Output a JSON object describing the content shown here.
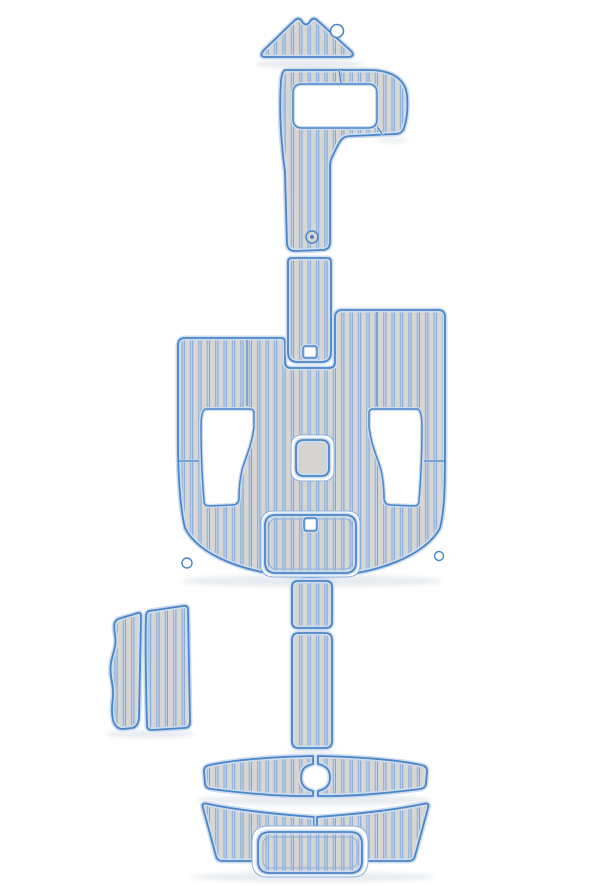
{
  "image": {
    "subject": "EVA foam teak-style boat decking pad kit, full set laid out in boat-deck arrangement on white background",
    "background_color": "#ffffff"
  },
  "canvas": {
    "width": 600,
    "height": 886
  },
  "colors": {
    "plank": "#d8d6d2",
    "groove": "#7aa4d8",
    "groove_light": "#c5d5eb",
    "edge": "#4a85c8",
    "halo": "#cddcef",
    "plain_pad": "#d6d4d0",
    "recess_stroke": "#8fb2de",
    "white": "#ffffff",
    "shadow": "#dfe4ea"
  },
  "pattern": {
    "plank_pitch": 8.4,
    "plank_width": 5.2,
    "groove_line": 1.0,
    "groove_gap": 1.2
  },
  "shadows": [
    {
      "cx": 309,
      "cy": 64,
      "rx": 54,
      "ry": 4.5,
      "o": 0.75
    },
    {
      "cx": 392,
      "cy": 140,
      "rx": 16,
      "ry": 3,
      "o": 0.6
    },
    {
      "cx": 312,
      "cy": 581,
      "rx": 132,
      "ry": 6,
      "o": 0.7
    },
    {
      "cx": 150,
      "cy": 734,
      "rx": 45,
      "ry": 4,
      "o": 0.7
    },
    {
      "cx": 312,
      "cy": 752,
      "rx": 26,
      "ry": 3,
      "o": 0.6
    },
    {
      "cx": 315,
      "cy": 800,
      "rx": 118,
      "ry": 5.5,
      "o": 0.7
    },
    {
      "cx": 313,
      "cy": 877,
      "rx": 122,
      "ry": 5,
      "o": 0.7
    }
  ],
  "pieces": [
    {
      "id": "cockpit-floor-pad",
      "label": "main cockpit floor pad with seat cutouts",
      "fill": "planks",
      "path": "M 188,338 L 281,338 Q 285,338 285,342 L 285,362 Q 285,368 291,368 L 329,368 Q 335,368 335,362 L 335,316 Q 336,310 342,310 L 438,310 Q 445,310 445,317 L 445,452 C 445,492 444,512 440,528 C 427,553 381,576 312,577 C 243,576 197,553 185,528 C 180,508 178,472 178,442 L 178,345 Q 178,338 185,338 Z",
      "features": [
        {
          "type": "groove",
          "x1": 247,
          "y1": 340,
          "x2": 247,
          "y2": 406
        },
        {
          "type": "groove",
          "x1": 377,
          "y1": 312,
          "x2": 377,
          "y2": 406
        },
        {
          "type": "groove",
          "x1": 179,
          "y1": 461,
          "x2": 199,
          "y2": 461
        },
        {
          "type": "groove",
          "x1": 424,
          "y1": 461,
          "x2": 444,
          "y2": 461
        },
        {
          "type": "cutout-path",
          "path": "M 206,409 L 250,409 Q 254,409 254,413 L 254,427 C 252,445 246,456 242,470 C 240,479 239,489 239,498 Q 239,505 232,505 L 209,506 Q 204,506 204,501 C 202,478 201,452 201,427 Q 201,409 206,409 Z"
        },
        {
          "type": "cutout-path",
          "path": "M 417,409 L 373,409 Q 369,409 369,413 L 369,427 C 371,445 377,456 381,470 C 383,479 384,489 384,498 Q 384,505 391,505 L 414,506 Q 419,506 419,501 C 421,478 422,452 422,427 Q 422,409 417,409 Z"
        },
        {
          "type": "notch",
          "cx": 187,
          "cy": 563,
          "r": 5
        },
        {
          "type": "notch",
          "cx": 439,
          "cy": 556,
          "r": 4.5
        }
      ]
    },
    {
      "id": "center-console-recess",
      "label": "white recess around center pedestal pad",
      "fill": "white",
      "rect": {
        "x": 291,
        "y": 435,
        "w": 43,
        "h": 46,
        "r": 11
      },
      "features": []
    },
    {
      "id": "center-console-pad",
      "label": "small square pedestal pad",
      "fill": "plain",
      "rect": {
        "x": 296,
        "y": 440,
        "w": 33,
        "h": 36,
        "r": 8
      },
      "features": []
    },
    {
      "id": "aft-hatch-recess",
      "label": "white recess around aft hatch pad",
      "fill": "white",
      "rect": {
        "x": 261,
        "y": 511,
        "w": 99,
        "h": 66,
        "r": 13
      },
      "features": []
    },
    {
      "id": "aft-hatch-pad",
      "label": "aft hatch pad with access hole",
      "fill": "planks",
      "rect": {
        "x": 265,
        "y": 515,
        "w": 91,
        "h": 58,
        "r": 11
      },
      "features": [
        {
          "type": "inner-line",
          "x": 269,
          "y": 519,
          "w": 83,
          "h": 50,
          "r": 8
        },
        {
          "type": "square-hole",
          "x": 304,
          "y": 518,
          "w": 13,
          "h": 13,
          "r": 3
        }
      ]
    },
    {
      "id": "walkway-strip-upper",
      "label": "upper walkway strip with square cutout",
      "fill": "planks",
      "path": "M 292,258 L 327,258 Q 331,258 331,262 L 331,352 Q 331,362 321,362 L 298,362 Q 288,362 288,352 L 288,262 Q 288,258 292,258 Z",
      "features": [
        {
          "type": "square-hole",
          "x": 303,
          "y": 346,
          "w": 14,
          "h": 12,
          "r": 3
        }
      ]
    },
    {
      "id": "bow-ring-pad",
      "label": "bow pad with anchor locker cutout and walkway arm",
      "fill": "planks",
      "path": "M 286,70 L 368,70 C 392,70 405,79 407,95 C 408,107 407,119 404,128 Q 402,134 395,134 L 351,136 C 342,136 340,141 337,147 L 332,157 Q 330,161 330,167 L 330,242 Q 330,250 322,250 L 295,251 Q 288,251 287,244 L 285,172 C 281,142 279,110 281,81 Q 282,70 286,70 Z",
      "features": [
        {
          "type": "cutout",
          "x": 293,
          "y": 84,
          "w": 84,
          "h": 44,
          "r": 9
        },
        {
          "type": "groove",
          "x1": 339,
          "y1": 70,
          "x2": 341,
          "y2": 83
        },
        {
          "type": "groove",
          "x1": 378,
          "y1": 128,
          "x2": 383,
          "y2": 135
        },
        {
          "type": "fitting",
          "cx": 312,
          "cy": 237,
          "r": 6
        }
      ]
    },
    {
      "id": "bow-triangle-pad",
      "label": "triangular bow tip pad with hole",
      "fill": "planks",
      "path": "M 266,57 L 347,57 Q 356,57 351,51 L 318,21 Q 314,17 311,20 L 309,23 Q 306,26 303,23 L 301,20 Q 298,17 294,21 L 264,50 Q 258,57 266,57 Z",
      "features": [
        {
          "type": "hole",
          "cx": 337,
          "cy": 31,
          "r": 6.5
        }
      ]
    },
    {
      "id": "side-step-pad-left",
      "label": "left side step pad with contoured edge",
      "fill": "planks",
      "path": "M 138,613 Q 141,612 141,617 L 139,718 Q 138,727 132,728 L 123,729 Q 117,729 114,723 C 111,715 112,705 113,696 C 114,684 109,677 111,663 C 113,651 117,647 115,635 C 114,627 113,622 118,619 Z",
      "features": []
    },
    {
      "id": "side-step-pad-right",
      "label": "right side step pad",
      "fill": "planks",
      "path": "M 149,611 L 183,606 Q 188,605 188,610 L 190,722 Q 190,728 184,728 L 152,730 Q 147,730 147,725 C 146,688 145,652 146,617 Q 146,612 149,611 Z",
      "features": []
    },
    {
      "id": "walkway-strip-middle",
      "label": "short walkway strip segment",
      "fill": "planks",
      "rect": {
        "x": 292,
        "y": 581,
        "w": 40,
        "h": 47,
        "r": 6
      },
      "features": []
    },
    {
      "id": "walkway-strip-lower",
      "label": "long walkway strip segment",
      "fill": "planks",
      "rect": {
        "x": 292,
        "y": 633,
        "w": 40,
        "h": 115,
        "r": 7
      },
      "features": []
    },
    {
      "id": "swim-platform-pad-left",
      "label": "left swim platform pad half with ladder notch",
      "fill": "planks",
      "path": "M 313,756 C 272,757 233,760 210,765 Q 204,766 204,771 L 205,783 Q 205,788 211,789 C 243,793 276,796 301,796 L 313,796 L 313,791 C 304,789 301,784 301,778 C 301,770 304,766 313,764 L 313,757 Z",
      "features": []
    },
    {
      "id": "swim-platform-pad-right",
      "label": "right swim platform pad half with ladder notch",
      "fill": "planks",
      "path": "M 318,756 C 359,757 398,760 421,765 Q 427,766 427,771 L 426,783 Q 426,788 420,789 C 388,793 355,796 330,796 L 318,796 L 318,791 C 327,789 330,784 330,778 C 330,770 327,766 318,764 L 318,757 Z",
      "features": []
    },
    {
      "id": "transom-pad-left",
      "label": "left transom pad half",
      "fill": "planks",
      "path": "M 314,817 C 272,814 232,809 208,804 Q 201,802 203,808 L 216,856 Q 217,861 223,861 L 314,861 Z",
      "features": []
    },
    {
      "id": "transom-pad-right",
      "label": "right transom pad half",
      "fill": "planks",
      "path": "M 317,817 C 359,814 399,809 423,804 Q 430,802 428,808 L 415,856 Q 414,861 408,861 L 317,861 Z",
      "features": []
    },
    {
      "id": "transom-step-recess",
      "label": "white recess around transom step pad",
      "fill": "white",
      "rect": {
        "x": 252,
        "y": 826,
        "w": 116,
        "h": 51,
        "r": 16
      },
      "features": []
    },
    {
      "id": "transom-step-pad",
      "label": "transom center step pad",
      "fill": "planks",
      "rect": {
        "x": 258,
        "y": 832,
        "w": 104,
        "h": 41,
        "r": 12
      },
      "features": [
        {
          "type": "inner-line",
          "x": 263,
          "y": 837,
          "w": 94,
          "h": 31,
          "r": 8
        }
      ]
    }
  ]
}
